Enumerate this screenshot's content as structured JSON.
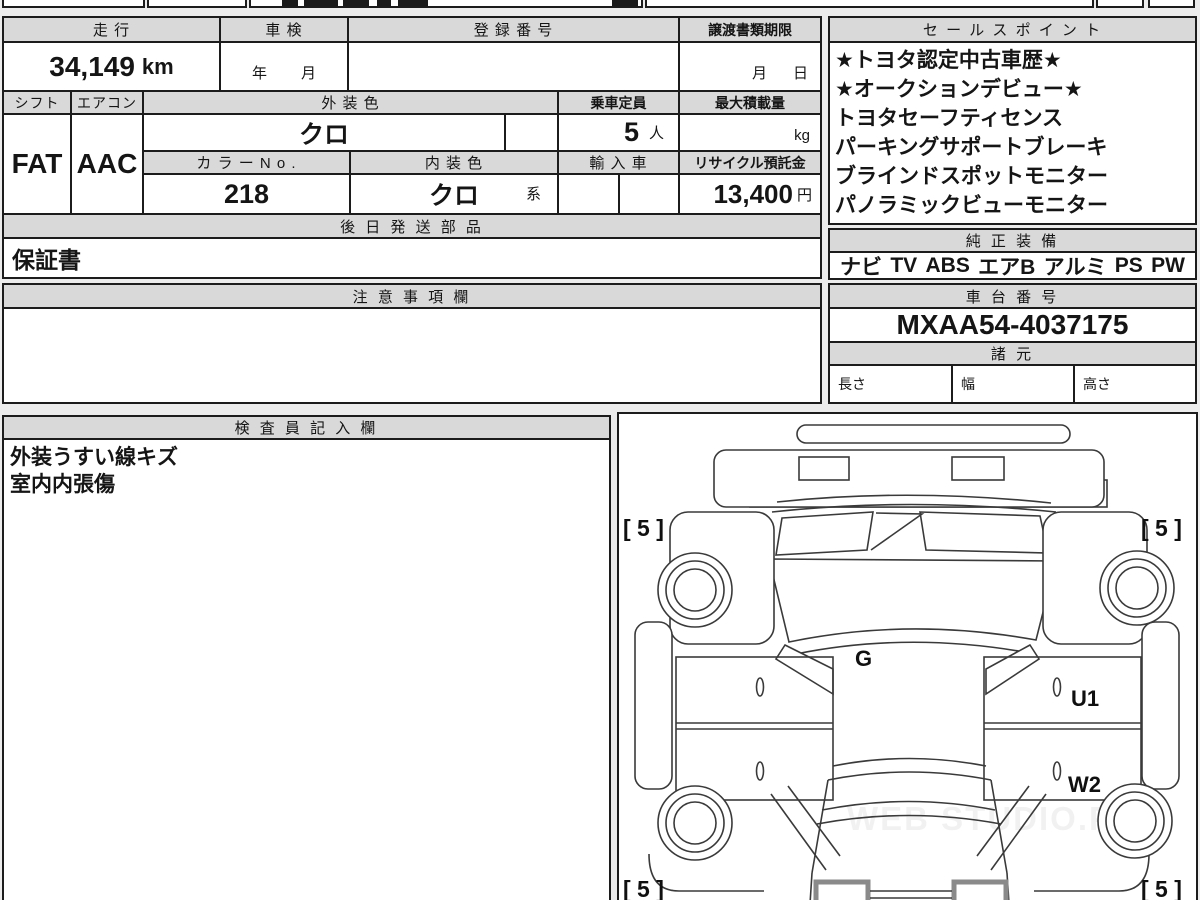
{
  "sheet": {
    "mileage": {
      "label": "走 行",
      "value": "34,149",
      "unit": "km"
    },
    "inspection": {
      "label": "車 検",
      "year_unit": "年",
      "month_unit": "月"
    },
    "registration_no": {
      "label": "登 録 番 号",
      "value": ""
    },
    "transfer_docs_deadline": {
      "label": "譲渡書類期限",
      "month_unit": "月",
      "day_unit": "日"
    },
    "shift": {
      "label": "シフト",
      "value": "FAT"
    },
    "aircon": {
      "label": "エアコン",
      "value": "AAC"
    },
    "exterior_color": {
      "label": "外 装 色",
      "value": "クロ"
    },
    "seating_capacity": {
      "label": "乗車定員",
      "value": "5",
      "unit": "人"
    },
    "max_load": {
      "label": "最大積載量",
      "value": "",
      "unit": "kg"
    },
    "color_no": {
      "label": "カ ラ ー N o .",
      "value": "218"
    },
    "interior_color": {
      "label": "内 装 色",
      "value": "クロ",
      "suffix": "系"
    },
    "imported_car": {
      "label": "輸 入 車",
      "value": ""
    },
    "recycle_deposit": {
      "label": "リサイクル預託金",
      "value": "13,400",
      "unit": "円"
    },
    "later_shipped_parts": {
      "label": "後 日 発 送 部 品",
      "value": "保証書"
    },
    "cautions": {
      "label": "注 意 事 項 欄",
      "value": ""
    }
  },
  "sales_points": {
    "label": "セ ー ル ス ポ イ ン ト",
    "lines": [
      "★トヨタ認定中古車歴★",
      "★オークションデビュー★",
      "トヨタセーフティセンス",
      "パーキングサポートブレーキ",
      "ブラインドスポットモニター",
      "パノラミックビューモニター"
    ]
  },
  "genuine_equipment": {
    "label": "純 正 装 備",
    "items": [
      "ナビ",
      "TV",
      "ABS",
      "エアB",
      "アルミ",
      "PS",
      "PW"
    ]
  },
  "chassis_no": {
    "label": "車 台 番 号",
    "value": "MXAA54-4037175"
  },
  "dimensions": {
    "label": "諸 元",
    "length_label": "長さ",
    "width_label": "幅",
    "height_label": "高さ"
  },
  "inspector_notes": {
    "label": "検 査 員 記 入 欄",
    "lines": [
      "外装うすい線キズ",
      "室内内張傷"
    ]
  },
  "diagram": {
    "tire_tread_front_left": "[ 5 ]",
    "tire_tread_front_right": "[ 5 ]",
    "tire_tread_rear_left": "[ 5 ]",
    "tire_tread_rear_right": "[ 5 ]",
    "glass_mark": "G",
    "damage_mark_u1": "U1",
    "damage_mark_w2": "W2",
    "watermark": "WEB STUDIO.PRO"
  },
  "colors": {
    "header_bg": "#d9d9d9",
    "page_bg": "#ececec",
    "border": "#1c1c1c",
    "diagram_line": "#3a3a3a"
  }
}
